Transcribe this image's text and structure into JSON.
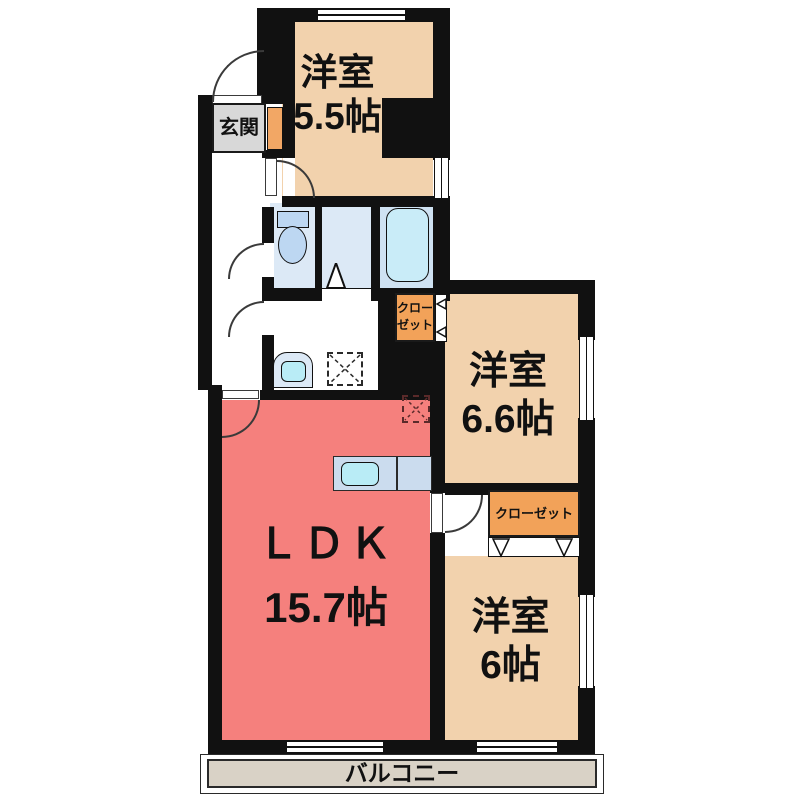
{
  "rooms": {
    "western_5_5": {
      "name": "洋室",
      "size": "5.5帖"
    },
    "western_6_6": {
      "name": "洋室",
      "size": "6.6帖"
    },
    "western_6": {
      "name": "洋室",
      "size": "6帖"
    },
    "ldk": {
      "name": "ＬＤＫ",
      "size": "15.7帖"
    },
    "genkan": {
      "label": "玄関"
    },
    "balcony": {
      "label": "バルコニー"
    },
    "closet_hall": {
      "label": "クローゼット"
    },
    "closet_66": {
      "label": "クローゼット"
    }
  },
  "colors": {
    "wall": "#111111",
    "line": "#3a3a3a",
    "beige": "#f2d2ad",
    "pink": "#f5807d",
    "blue1": "#dce9f6",
    "blue2": "#cfe2f2",
    "tub": "#c9ecf8",
    "cyan": "#b9ecf6",
    "fixture": "#bdd7f2",
    "counter": "#cbdcee",
    "orange": "#f2a259",
    "shoe": "#f2a765",
    "gray": "#d8d8d8",
    "balcony": "#d9d2c6"
  }
}
